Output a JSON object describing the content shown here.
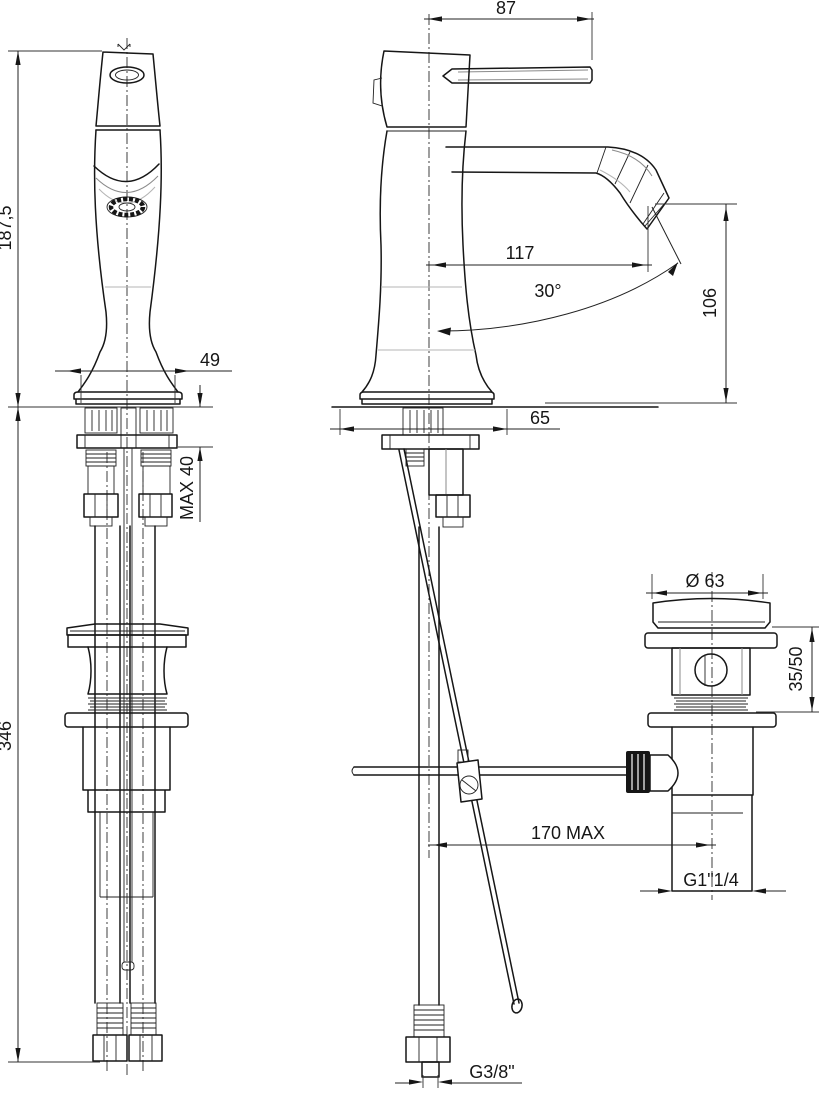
{
  "drawing": {
    "type": "faucet-technical-drawing",
    "views": {
      "front_view": "single-hole basin mixer, front elevation with supply hoses and pop-up waste",
      "side_view": "basin mixer, side elevation with lever, spout and pop-up rod",
      "drain_view": "pop-up waste drain, side elevation"
    },
    "line_color": "#161616",
    "dimensions": {
      "lever_width": "87",
      "height_above_deck": "187,5",
      "handle_base_width": "49",
      "spout_reach": "117",
      "spout_angle": "30°",
      "spout_height": "106",
      "base_depth": "65",
      "max_counter_thickness": "MAX 40",
      "below_deck_length": "346",
      "drain_flange_diameter": "Ø 63",
      "drain_clamp_range": "35/50",
      "rod_horizontal_max": "170 MAX",
      "drain_outlet_thread": "G1\"1/4",
      "supply_hose_thread": "G3/8\""
    }
  }
}
